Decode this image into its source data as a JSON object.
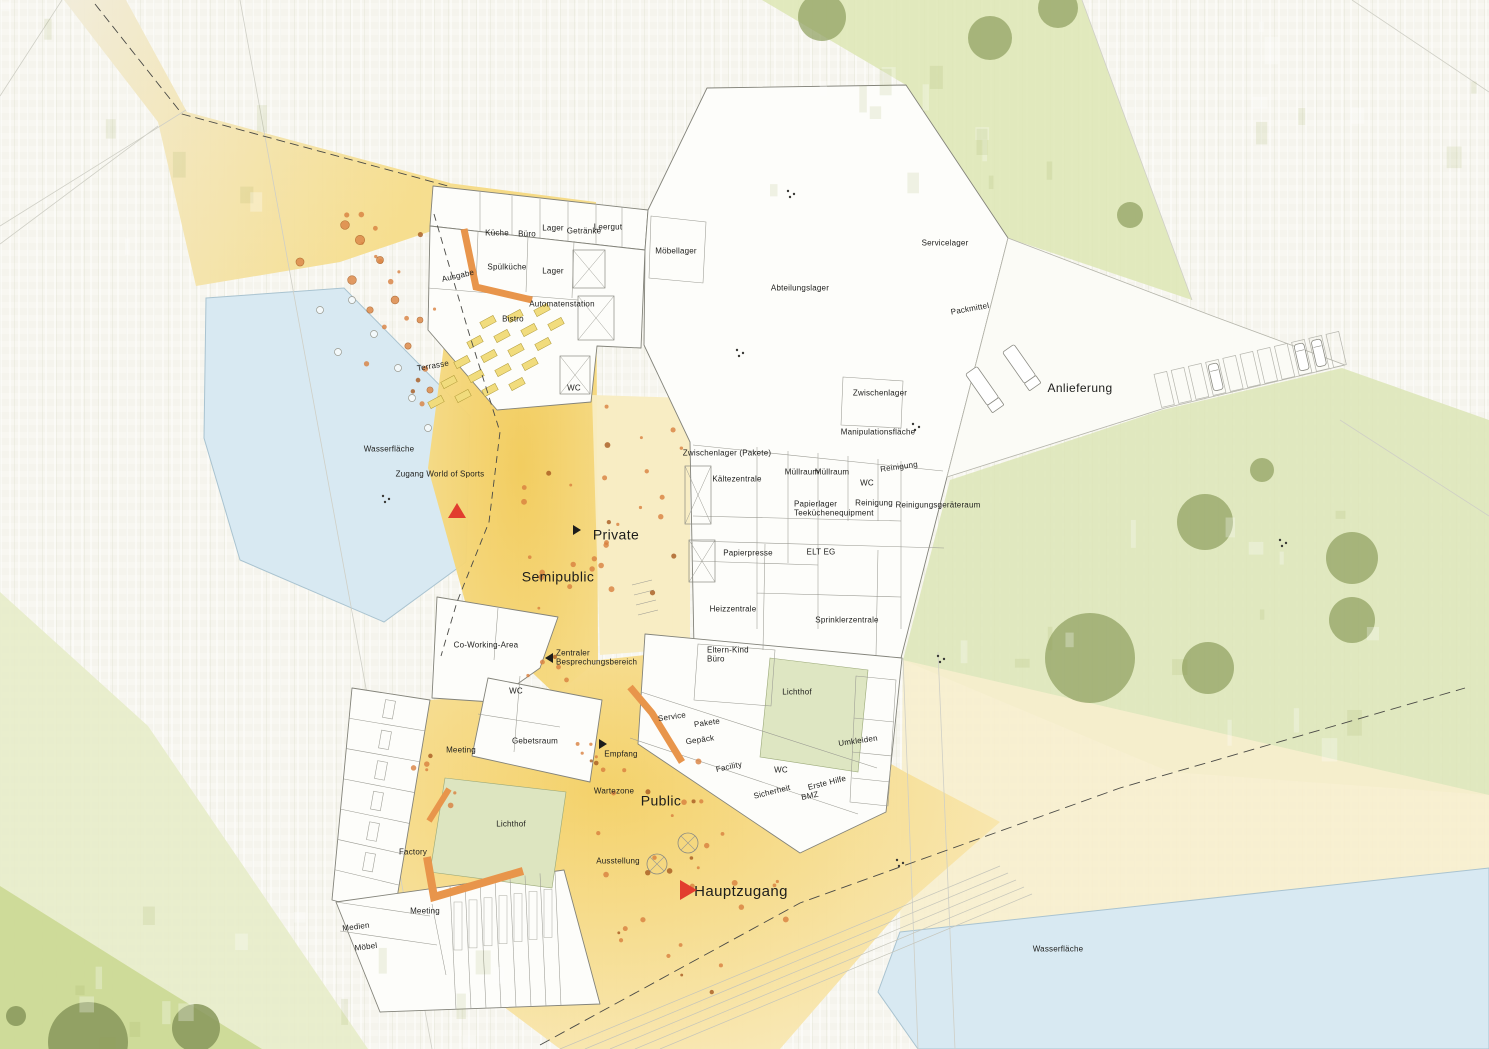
{
  "plan_type": "Erdgeschoss Lageplan",
  "colors": {
    "background": "#f7f6ef",
    "water": "#d8e9f2",
    "water_edge": "#a9c3d0",
    "green_light": "#e3eac2",
    "green_mid": "#cfdc9e",
    "tree": "#8f9f60",
    "tree_dark": "#87975a",
    "zone_yellow": "#f5d367",
    "zone_yellow_soft": "#f8e8b4",
    "zone_pale_yellow": "#f8ecc2",
    "path_beige": "#f1e9d2",
    "building_fill": "#fdfdfa",
    "line_gray": "#83837a",
    "wall_gray": "#9a9a92",
    "orange_accent": "#e8954b",
    "marker_red": "#e23d2e",
    "text": "#1d1d1b"
  },
  "zone_labels": [
    {
      "id": "private",
      "text": "Private",
      "x": 616,
      "y": 535,
      "fs": 14
    },
    {
      "id": "semipublic",
      "text": "Semipublic",
      "x": 558,
      "y": 577,
      "fs": 14
    },
    {
      "id": "public",
      "text": "Public",
      "x": 661,
      "y": 801,
      "fs": 14
    },
    {
      "id": "hauptzugang",
      "text": "Hauptzugang",
      "x": 741,
      "y": 892,
      "fs": 15
    },
    {
      "id": "anlieferung",
      "text": "Anlieferung",
      "x": 1080,
      "y": 388,
      "fs": 12
    }
  ],
  "area_labels": [
    {
      "id": "wasserflaeche-west",
      "text": "Wasserfläche",
      "x": 389,
      "y": 449,
      "fs": 8
    },
    {
      "id": "wasserflaeche-suedost",
      "text": "Wasserfläche",
      "x": 1058,
      "y": 949,
      "fs": 8
    },
    {
      "id": "zugang-world-of-sports",
      "text": "Zugang World of Sports",
      "x": 440,
      "y": 474,
      "fs": 8
    }
  ],
  "room_labels": [
    {
      "id": "kueche",
      "text": "Küche",
      "x": 497,
      "y": 233
    },
    {
      "id": "buero",
      "text": "Büro",
      "x": 527,
      "y": 234
    },
    {
      "id": "lager-nord",
      "text": "Lager",
      "x": 553,
      "y": 228
    },
    {
      "id": "getraenke",
      "text": "Getränke",
      "x": 584,
      "y": 231
    },
    {
      "id": "leergut",
      "text": "Leergut",
      "x": 608,
      "y": 227
    },
    {
      "id": "moebellager",
      "text": "Möbellager",
      "x": 676,
      "y": 251
    },
    {
      "id": "ausgabe",
      "text": "Ausgabe",
      "x": 458,
      "y": 276,
      "rot": -13
    },
    {
      "id": "spuelkueche",
      "text": "Spülküche",
      "x": 507,
      "y": 267
    },
    {
      "id": "lager-sued",
      "text": "Lager",
      "x": 553,
      "y": 271
    },
    {
      "id": "automatenstation",
      "text": "Automatenstation",
      "x": 562,
      "y": 304
    },
    {
      "id": "bistro",
      "text": "Bistro",
      "x": 513,
      "y": 319
    },
    {
      "id": "terrasse",
      "text": "Terrasse",
      "x": 433,
      "y": 366,
      "rot": -10
    },
    {
      "id": "wc-bistro",
      "text": "WC",
      "x": 574,
      "y": 388
    },
    {
      "id": "abteilungslager",
      "text": "Abteilungslager",
      "x": 800,
      "y": 288
    },
    {
      "id": "servicelager",
      "text": "Servicelager",
      "x": 945,
      "y": 243
    },
    {
      "id": "packmittel",
      "text": "Packmittel",
      "x": 970,
      "y": 309,
      "rot": -10
    },
    {
      "id": "zwischenlager",
      "text": "Zwischenlager",
      "x": 880,
      "y": 393
    },
    {
      "id": "manipulationsflaeche",
      "text": "Manipulationsfläche",
      "x": 878,
      "y": 432
    },
    {
      "id": "zwischenlager-pakete",
      "text": "Zwischenlager (Pakete)",
      "x": 727,
      "y": 453
    },
    {
      "id": "kaeltezentrale",
      "text": "Kältezentrale",
      "x": 737,
      "y": 479
    },
    {
      "id": "muellraum-1",
      "text": "Müllraum",
      "x": 802,
      "y": 472
    },
    {
      "id": "muellraum-2",
      "text": "Müllraum",
      "x": 832,
      "y": 472
    },
    {
      "id": "wc-technik",
      "text": "WC",
      "x": 867,
      "y": 483
    },
    {
      "id": "reinigung-1",
      "text": "Reinigung",
      "x": 899,
      "y": 467,
      "rot": -8
    },
    {
      "id": "reinigung-2",
      "text": "Reinigung",
      "x": 874,
      "y": 503
    },
    {
      "id": "reinigungsgeraeteraum",
      "text": "Reinigungsgeräteraum",
      "x": 938,
      "y": 505
    },
    {
      "id": "papierlager",
      "text": "Papierlager",
      "x": 794,
      "y": 504,
      "align": "left"
    },
    {
      "id": "teekuechenequipment",
      "text": "Teeküchenequipment",
      "x": 794,
      "y": 513,
      "align": "left"
    },
    {
      "id": "papierpresse",
      "text": "Papierpresse",
      "x": 748,
      "y": 553
    },
    {
      "id": "elt-eg",
      "text": "ELT EG",
      "x": 821,
      "y": 552
    },
    {
      "id": "heizzentrale",
      "text": "Heizzentrale",
      "x": 733,
      "y": 609
    },
    {
      "id": "sprinklerzentrale",
      "text": "Sprinklerzentrale",
      "x": 847,
      "y": 620
    },
    {
      "id": "co-working-area",
      "text": "Co-Working-Area",
      "x": 486,
      "y": 645
    },
    {
      "id": "zentraler-besprechungsbereich",
      "text": "Zentraler\nBesprechungsbereich",
      "x": 556,
      "y": 658,
      "align": "left"
    },
    {
      "id": "wc-coworking",
      "text": "WC",
      "x": 516,
      "y": 691
    },
    {
      "id": "gebetsraum",
      "text": "Gebetsraum",
      "x": 535,
      "y": 741
    },
    {
      "id": "meeting-west",
      "text": "Meeting",
      "x": 461,
      "y": 750
    },
    {
      "id": "eltern-kind-buero",
      "text": "Eltern-Kind\nBüro",
      "x": 707,
      "y": 655,
      "align": "left"
    },
    {
      "id": "lichthof-ost",
      "text": "Lichthof",
      "x": 797,
      "y": 692
    },
    {
      "id": "service",
      "text": "Service",
      "x": 672,
      "y": 717,
      "rot": -8
    },
    {
      "id": "pakete",
      "text": "Pakete",
      "x": 707,
      "y": 723,
      "rot": -8
    },
    {
      "id": "gepaeck",
      "text": "Gepäck",
      "x": 700,
      "y": 740,
      "rot": -8
    },
    {
      "id": "empfang",
      "text": "Empfang",
      "x": 621,
      "y": 754
    },
    {
      "id": "facility",
      "text": "Facility",
      "x": 729,
      "y": 767,
      "rot": -12
    },
    {
      "id": "wc-facility",
      "text": "WC",
      "x": 781,
      "y": 770
    },
    {
      "id": "sicherheit",
      "text": "Sicherheit",
      "x": 772,
      "y": 792,
      "rot": -14
    },
    {
      "id": "erste-hilfe",
      "text": "Erste Hilfe",
      "x": 827,
      "y": 783,
      "rot": -14
    },
    {
      "id": "bmz",
      "text": "BMZ",
      "x": 810,
      "y": 796,
      "rot": -12
    },
    {
      "id": "umkleiden",
      "text": "Umkleiden",
      "x": 858,
      "y": 741,
      "rot": -8
    },
    {
      "id": "wartezone",
      "text": "Wartezone",
      "x": 614,
      "y": 791
    },
    {
      "id": "lichthof-west",
      "text": "Lichthof",
      "x": 511,
      "y": 824
    },
    {
      "id": "factory",
      "text": "Factory",
      "x": 413,
      "y": 852
    },
    {
      "id": "ausstellung",
      "text": "Ausstellung",
      "x": 618,
      "y": 861
    },
    {
      "id": "meeting-sued",
      "text": "Meeting",
      "x": 425,
      "y": 911
    },
    {
      "id": "medien",
      "text": "Medien",
      "x": 356,
      "y": 927,
      "rot": -7
    },
    {
      "id": "moebel",
      "text": "Möbel",
      "x": 366,
      "y": 947,
      "rot": -7
    }
  ],
  "markers": [
    {
      "id": "zugang-world-of-sports",
      "shape": "triangle-up",
      "color_key": "marker_red",
      "x": 457,
      "y": 510,
      "size": 15
    },
    {
      "id": "hauptzugang",
      "shape": "triangle-right",
      "color_key": "marker_red",
      "x": 688,
      "y": 890,
      "size": 17
    },
    {
      "id": "private-entry",
      "shape": "triangle-right",
      "color_key": "text",
      "x": 577,
      "y": 530,
      "size": 8
    },
    {
      "id": "besprechungsbereich",
      "shape": "triangle-left",
      "color_key": "text",
      "x": 549,
      "y": 658,
      "size": 8
    },
    {
      "id": "empfang",
      "shape": "triangle-right",
      "color_key": "text",
      "x": 603,
      "y": 744,
      "size": 8
    }
  ]
}
